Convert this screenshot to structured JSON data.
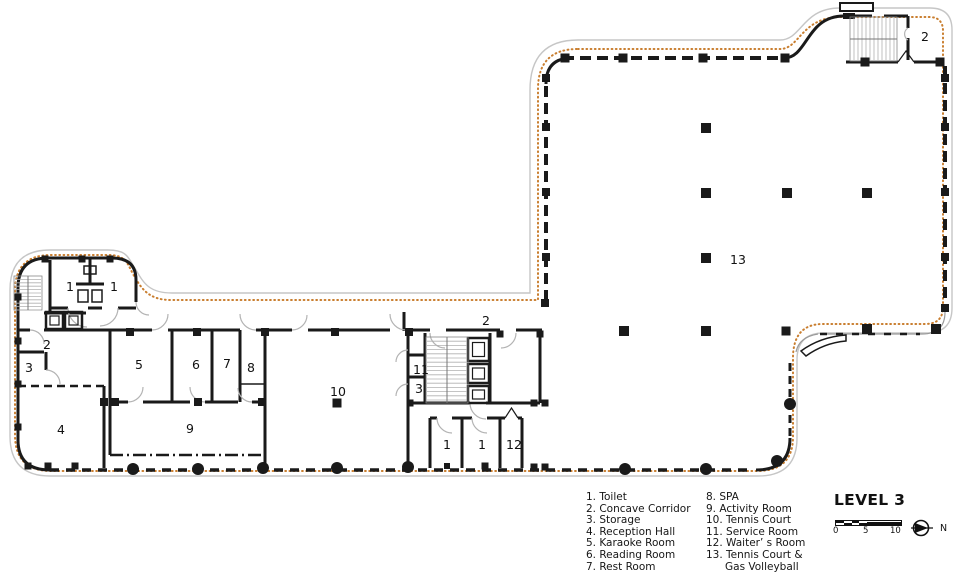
{
  "plan": {
    "title": "LEVEL 3",
    "north_label": "N",
    "scale_ticks": [
      "0",
      "5",
      "10"
    ],
    "legend": {
      "col1": [
        {
          "text": "1. Toilet"
        },
        {
          "text": "2. Concave Corridor"
        },
        {
          "text": "3. Storage"
        },
        {
          "text": "4. Reception Hall"
        },
        {
          "text": "5. Karaoke Room"
        },
        {
          "text": "6. Reading Room"
        },
        {
          "text": "7. Rest Room"
        }
      ],
      "col2": [
        {
          "text": "8. SPA"
        },
        {
          "text": "9. Activity Room"
        },
        {
          "text": "10. Tennis Court"
        },
        {
          "text": "11. Service Room"
        },
        {
          "text": "12. Waiter’ s Room"
        },
        {
          "text": "13. Tennis Court &"
        },
        {
          "text": "Gas Volleyball",
          "indent": true
        }
      ]
    },
    "room_labels": [
      {
        "t": "1",
        "x": 70,
        "y": 291
      },
      {
        "t": "1",
        "x": 114,
        "y": 291
      },
      {
        "t": "2",
        "x": 47,
        "y": 349
      },
      {
        "t": "3",
        "x": 29,
        "y": 372
      },
      {
        "t": "4",
        "x": 61,
        "y": 434
      },
      {
        "t": "5",
        "x": 139,
        "y": 369
      },
      {
        "t": "6",
        "x": 196,
        "y": 369
      },
      {
        "t": "7",
        "x": 227,
        "y": 368
      },
      {
        "t": "8",
        "x": 251,
        "y": 372
      },
      {
        "t": "9",
        "x": 190,
        "y": 433
      },
      {
        "t": "10",
        "x": 338,
        "y": 396
      },
      {
        "t": "11",
        "x": 421,
        "y": 374
      },
      {
        "t": "3",
        "x": 419,
        "y": 393
      },
      {
        "t": "2",
        "x": 486,
        "y": 325
      },
      {
        "t": "1",
        "x": 447,
        "y": 449
      },
      {
        "t": "1",
        "x": 482,
        "y": 449
      },
      {
        "t": "12",
        "x": 514,
        "y": 449
      },
      {
        "t": "2",
        "x": 925,
        "y": 41
      },
      {
        "t": "13",
        "x": 738,
        "y": 264
      }
    ],
    "columns_square": [
      [
        706,
        128,
        10
      ],
      [
        706,
        193,
        10
      ],
      [
        787,
        193,
        10
      ],
      [
        867,
        193,
        10
      ],
      [
        706,
        258,
        10
      ],
      [
        624,
        331,
        10
      ],
      [
        706,
        331,
        10
      ],
      [
        786,
        331,
        9
      ],
      [
        867,
        329,
        10
      ],
      [
        936,
        329,
        10
      ],
      [
        565,
        58,
        9
      ],
      [
        623,
        58,
        9
      ],
      [
        703,
        58,
        9
      ],
      [
        785,
        58,
        9
      ],
      [
        865,
        62,
        9
      ],
      [
        940,
        62,
        9
      ],
      [
        546,
        78,
        8
      ],
      [
        546,
        127,
        8
      ],
      [
        546,
        192,
        8
      ],
      [
        546,
        257,
        8
      ],
      [
        545,
        303,
        8
      ],
      [
        945,
        78,
        8
      ],
      [
        945,
        127,
        8
      ],
      [
        945,
        192,
        8
      ],
      [
        945,
        257,
        8
      ],
      [
        945,
        308,
        8
      ],
      [
        130,
        332,
        8
      ],
      [
        197,
        332,
        8
      ],
      [
        265,
        332,
        8
      ],
      [
        335,
        332,
        8
      ],
      [
        409,
        332,
        8
      ],
      [
        500,
        334,
        7
      ],
      [
        540,
        334,
        7
      ],
      [
        115,
        402,
        8
      ],
      [
        198,
        402,
        8
      ],
      [
        262,
        402,
        8
      ],
      [
        337,
        403,
        9
      ],
      [
        104,
        402,
        8
      ],
      [
        410,
        403,
        7
      ],
      [
        534,
        403,
        7
      ],
      [
        545,
        403,
        7
      ],
      [
        534,
        467,
        7
      ],
      [
        545,
        467,
        7
      ],
      [
        447,
        466,
        6
      ],
      [
        485,
        466,
        7
      ],
      [
        45,
        259,
        7
      ],
      [
        82,
        259,
        7
      ],
      [
        110,
        259,
        7
      ],
      [
        18,
        297,
        7
      ],
      [
        18,
        341,
        7
      ],
      [
        18,
        384,
        7
      ],
      [
        18,
        427,
        7
      ],
      [
        28,
        466,
        7
      ],
      [
        48,
        466,
        7
      ],
      [
        75,
        466,
        7
      ]
    ],
    "columns_round": [
      [
        133,
        469,
        6
      ],
      [
        198,
        469,
        6
      ],
      [
        263,
        468,
        6
      ],
      [
        337,
        468,
        6
      ],
      [
        408,
        467,
        6
      ],
      [
        625,
        469,
        6
      ],
      [
        706,
        469,
        6
      ],
      [
        777,
        461,
        6
      ],
      [
        790,
        404,
        6
      ]
    ],
    "colors": {
      "wall": "#1a1a1a",
      "boundary_gray": "#c6c6c6",
      "perimeter_dots_orange": "#c97e2f",
      "door_arc_gray": "#b3b3b3",
      "stair_tread_gray": "#b0b0b0",
      "text": "#111111"
    }
  }
}
